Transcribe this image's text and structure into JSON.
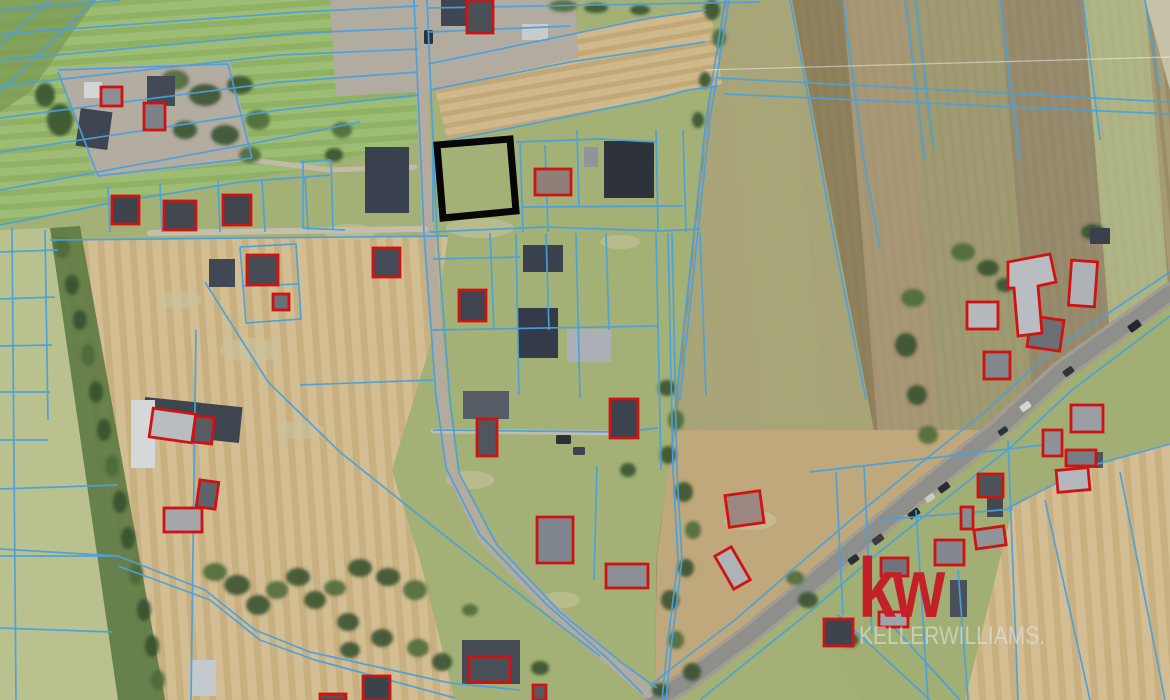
{
  "watermark": {
    "logo": "kw",
    "brand": "KELLERWILLIAMS."
  },
  "colors": {
    "parcel_line": "#4aa0dc",
    "building_outline": "#cf1313",
    "highlight": "#060606",
    "tree_dark": "#35502c",
    "tree_mid": "#4c6a39",
    "patch": "#cbc49e",
    "power_line": "rgba(255,255,255,0.45)",
    "kw_red": "#c32127",
    "brand_text": "rgba(228,233,241,0.55)",
    "base_grass": "#a3b176"
  },
  "highlight_parcel": {
    "points": "437,145 510,139 516,211 443,218",
    "stroke_width": 7
  },
  "map": {
    "patterns": [
      {
        "id": "rowsGreen",
        "c1": "#8fb163",
        "c2": "#9dbd74",
        "s": 14,
        "split": 8,
        "a": -4
      },
      {
        "id": "rowsTan",
        "c1": "#c2a877",
        "c2": "#cfb88b",
        "s": 12,
        "split": 7,
        "a": -10
      },
      {
        "id": "rowsTanV",
        "c1": "#c8b081",
        "c2": "#d3bd92",
        "s": 16,
        "split": 9,
        "a": 86
      },
      {
        "id": "rowsBrown",
        "c1": "#9a8d66",
        "c2": "#a79b73",
        "s": 10,
        "split": 6,
        "a": 84
      }
    ],
    "fields": [
      {
        "pts": "0,0 1170,0 1170,700 0,700",
        "fill": "#a3b176"
      },
      {
        "pts": "0,0 430,0 424,140 300,170 100,205 0,228",
        "fill": "p:rowsGreen"
      },
      {
        "pts": "0,0 96,0 30,92 0,112",
        "fill": "#7d9b55",
        "op": 0.8
      },
      {
        "pts": "676,400 692,250 706,120 725,0 1170,0 1170,293 1060,372 997,430 925,488 860,542 800,593 745,638 685,682 655,700 656,560 668,470",
        "fill": "p:rowsBrown"
      },
      {
        "pts": "727,0 790,0 828,470 765,470",
        "fill": "#a3a06e",
        "op": 0.8
      },
      {
        "pts": "790,0 843,0 881,470 828,470",
        "fill": "#8a7a58",
        "op": 0.8
      },
      {
        "pts": "843,0 905,0 943,470 881,470",
        "fill": "#a89674",
        "op": 0.8
      },
      {
        "pts": "905,0 1000,0 1038,470 943,470",
        "fill": "#9d9a70",
        "op": 0.8
      },
      {
        "pts": "1000,0 1083,0 1121,470 1038,470",
        "fill": "#93876b",
        "op": 0.8
      },
      {
        "pts": "1083,0 1145,0 1183,470 1121,470",
        "fill": "#b2ba8a",
        "op": 0.8
      },
      {
        "pts": "1145,0 1170,0 1170,90",
        "fill": "#c9c6ad",
        "op": 0.9
      },
      {
        "pts": "676,430 694,250 711,100 727,0 792,0 810,96 840,255 874,430",
        "fill": "#a9a578",
        "op": 0.95
      },
      {
        "pts": "925,488 1060,372 1170,293 1170,443 1090,465 1013,507 1005,700 860,700 800,593 860,542",
        "fill": "#a2af74"
      },
      {
        "pts": "676,430 874,430 997,430 925,488 860,542 800,593 745,638 685,682 655,700 657,560 668,470",
        "fill": "#bfa87b"
      },
      {
        "pts": "1013,507 1090,465 1170,443 1170,700 965,700",
        "fill": "p:rowsTanV"
      },
      {
        "pts": "50,240 448,237 432,340 392,470 420,560 455,700 160,700 96,470",
        "fill": "p:rowsTanV"
      },
      {
        "pts": "0,230 50,228 96,470 160,700 0,700",
        "fill": "#b9c28f"
      },
      {
        "pts": "50,228 80,226 165,700 118,700",
        "fill": "#5d7a44",
        "op": 0.9
      },
      {
        "pts": "428,62 650,16 710,8 722,84 690,90 448,142",
        "fill": "p:rowsTan"
      },
      {
        "pts": "58,68 230,62 254,160 96,178",
        "fill": "#b3aca0"
      },
      {
        "pts": "330,0 575,0 578,58 420,92 336,96",
        "fill": "#b2aba0"
      }
    ],
    "patches": [
      [
        480,
        228,
        34,
        10
      ],
      [
        350,
        232,
        26,
        8
      ],
      [
        620,
        242,
        20,
        7
      ],
      [
        470,
        480,
        24,
        9
      ],
      [
        560,
        600,
        20,
        8
      ],
      [
        750,
        520,
        26,
        10
      ],
      [
        250,
        350,
        30,
        12
      ],
      [
        300,
        430,
        24,
        9
      ],
      [
        180,
        300,
        22,
        9
      ]
    ],
    "roads": [
      {
        "pts": "1170,293 1060,372 997,430 925,488 860,542 800,593 745,638 685,682 655,700",
        "w": 22,
        "c": "#a29d90"
      },
      {
        "pts": "1170,293 1060,372 997,430 925,488 860,542 800,593 745,638 685,682 655,700",
        "w": 15,
        "c": "#8e8f8b"
      },
      {
        "pts": "418,0 428,233 442,400 451,470 484,538 548,606 610,660 648,692",
        "w": 12,
        "c": "#b4ab9d"
      },
      {
        "pts": "150,233 425,229",
        "w": 6,
        "c": "#c6bead"
      },
      {
        "pts": "433,431 618,433",
        "w": 5,
        "c": "#c4bcae"
      },
      {
        "pts": "252,160 330,170 415,167",
        "w": 5,
        "c": "#c2b9a8"
      }
    ],
    "vehicles": [
      [
        1128,
        322,
        13,
        8,
        -36,
        "#23272e"
      ],
      [
        1063,
        368,
        11,
        7,
        -36,
        "#30353c"
      ],
      [
        1020,
        403,
        11,
        7,
        -36,
        "#d4d6d2"
      ],
      [
        998,
        428,
        10,
        6,
        -36,
        "#2e333a"
      ],
      [
        938,
        484,
        12,
        7,
        -36,
        "#282d34"
      ],
      [
        925,
        495,
        10,
        6,
        -36,
        "#caccc8"
      ],
      [
        908,
        510,
        12,
        7,
        -36,
        "#23272e"
      ],
      [
        872,
        536,
        12,
        7,
        -36,
        "#383d44"
      ],
      [
        848,
        556,
        11,
        7,
        -36,
        "#2a2f36"
      ],
      [
        556,
        435,
        15,
        9,
        0,
        "#2c3138"
      ],
      [
        573,
        447,
        12,
        8,
        0,
        "#3d434c"
      ],
      [
        424,
        30,
        9,
        14,
        0,
        "#2e333a"
      ]
    ],
    "trees": [
      [
        175,
        80,
        14,
        10
      ],
      [
        205,
        95,
        16,
        11
      ],
      [
        240,
        85,
        13,
        9
      ],
      [
        258,
        120,
        12,
        10
      ],
      [
        225,
        135,
        14,
        10
      ],
      [
        185,
        130,
        12,
        9
      ],
      [
        250,
        155,
        11,
        8
      ],
      [
        60,
        120,
        13,
        16
      ],
      [
        45,
        95,
        10,
        12
      ],
      [
        563,
        6,
        14,
        6
      ],
      [
        596,
        8,
        12,
        5
      ],
      [
        640,
        10,
        10,
        5
      ],
      [
        342,
        130,
        10,
        8
      ],
      [
        334,
        155,
        9,
        7
      ],
      [
        712,
        10,
        8,
        10
      ],
      [
        719,
        38,
        7,
        9
      ],
      [
        705,
        80,
        6,
        8
      ],
      [
        698,
        120,
        6,
        8
      ],
      [
        963,
        252,
        12,
        9
      ],
      [
        988,
        268,
        11,
        8
      ],
      [
        1005,
        285,
        9,
        7
      ],
      [
        913,
        298,
        12,
        9
      ],
      [
        906,
        345,
        11,
        12
      ],
      [
        917,
        395,
        10,
        10
      ],
      [
        928,
        435,
        10,
        9
      ],
      [
        1093,
        232,
        12,
        8
      ],
      [
        667,
        388,
        9,
        8
      ],
      [
        676,
        420,
        8,
        10
      ],
      [
        668,
        455,
        8,
        9
      ],
      [
        684,
        492,
        9,
        10
      ],
      [
        693,
        530,
        8,
        9
      ],
      [
        686,
        568,
        8,
        9
      ],
      [
        670,
        600,
        9,
        10
      ],
      [
        676,
        640,
        8,
        9
      ],
      [
        692,
        672,
        9,
        9
      ],
      [
        660,
        690,
        8,
        7
      ],
      [
        215,
        572,
        12,
        9
      ],
      [
        237,
        585,
        13,
        10
      ],
      [
        258,
        605,
        12,
        10
      ],
      [
        277,
        590,
        11,
        9
      ],
      [
        298,
        577,
        12,
        9
      ],
      [
        315,
        600,
        11,
        9
      ],
      [
        335,
        588,
        11,
        8
      ],
      [
        360,
        568,
        12,
        9
      ],
      [
        388,
        577,
        12,
        9
      ],
      [
        415,
        590,
        12,
        10
      ],
      [
        348,
        622,
        11,
        9
      ],
      [
        382,
        638,
        11,
        9
      ],
      [
        418,
        648,
        11,
        9
      ],
      [
        442,
        662,
        10,
        9
      ],
      [
        350,
        650,
        10,
        8
      ],
      [
        62,
        248,
        8,
        10
      ],
      [
        72,
        285,
        7,
        10
      ],
      [
        80,
        320,
        7,
        10
      ],
      [
        88,
        355,
        7,
        11
      ],
      [
        96,
        392,
        7,
        11
      ],
      [
        104,
        430,
        7,
        11
      ],
      [
        112,
        466,
        7,
        11
      ],
      [
        120,
        502,
        7,
        11
      ],
      [
        128,
        538,
        7,
        11
      ],
      [
        136,
        574,
        7,
        11
      ],
      [
        144,
        610,
        7,
        11
      ],
      [
        152,
        646,
        7,
        11
      ],
      [
        158,
        680,
        7,
        10
      ],
      [
        500,
        655,
        10,
        8
      ],
      [
        540,
        668,
        9,
        7
      ],
      [
        470,
        610,
        8,
        6
      ],
      [
        628,
        470,
        8,
        7
      ],
      [
        808,
        600,
        10,
        8
      ],
      [
        795,
        578,
        9,
        7
      ],
      [
        850,
        640,
        9,
        7
      ]
    ],
    "buildings": [
      [
        78,
        110,
        32,
        38,
        8,
        "#3e4450"
      ],
      [
        84,
        82,
        18,
        16,
        0,
        "#d3d6d6"
      ],
      [
        147,
        76,
        28,
        30,
        0,
        "#434955"
      ],
      [
        209,
        259,
        26,
        28,
        0,
        "#414754"
      ],
      [
        365,
        147,
        44,
        66,
        0,
        "#39404e"
      ],
      [
        441,
        0,
        36,
        26,
        0,
        "#3f4552"
      ],
      [
        522,
        24,
        26,
        16,
        0,
        "#c8ccce"
      ],
      [
        584,
        147,
        14,
        20,
        0,
        "#8f959b"
      ],
      [
        604,
        141,
        50,
        57,
        0,
        "#2e333b"
      ],
      [
        523,
        245,
        40,
        27,
        0,
        "#39404e"
      ],
      [
        518,
        308,
        40,
        50,
        0,
        "#333a48"
      ],
      [
        567,
        329,
        44,
        33,
        0,
        "#aab0b6"
      ],
      [
        462,
        640,
        58,
        44,
        0,
        "#454b55"
      ],
      [
        463,
        391,
        46,
        28,
        0,
        "#565c66"
      ],
      [
        143,
        402,
        98,
        36,
        6,
        "#3f454e"
      ],
      [
        131,
        400,
        24,
        68,
        0,
        "#d5d8d8"
      ],
      [
        190,
        660,
        26,
        36,
        0,
        "#c3c9cc"
      ],
      [
        950,
        580,
        17,
        37,
        0,
        "#4b5158"
      ],
      [
        987,
        497,
        16,
        20,
        0,
        "#43494f"
      ],
      [
        1090,
        228,
        20,
        16,
        0,
        "#3a404c"
      ],
      [
        1085,
        452,
        18,
        16,
        0,
        "#4f555c"
      ]
    ],
    "parcel_lines": [
      "0,10 120,0",
      "0,34 300,12 418,6",
      "0,60 300,33 418,28",
      "0,86 280,55 418,49",
      "0,118 280,82 418,72",
      "0,152 280,110 418,95",
      "0,190 260,142 360,122",
      "0,225 100,205 240,182 330,175",
      "0,45 50,0",
      "0,92 95,0",
      "428,8 760,2",
      "428,32 570,26",
      "430,90 570,62 705,42",
      "428,64 650,18 706,10",
      "446,141 650,100 688,90 718,86",
      "718,78 1170,102",
      "724,94 1170,114",
      "414,0 424,233 436,395 446,468 480,535 545,603 607,658 643,694",
      "427,0 437,233 450,400 459,473 497,545 560,612 622,663 657,688",
      "205,282 268,382 340,452 440,532 540,610 600,656",
      "520,143 523,232",
      "545,145 548,232",
      "577,130 579,208",
      "656,130 658,232",
      "683,130 686,232",
      "516,142 600,139 656,142",
      "523,207 683,206",
      "430,232 545,227 660,231 700,229",
      "433,259 520,257",
      "433,143 433,222",
      "303,160 303,228",
      "331,160 333,230",
      "300,162 331,160",
      "302,228 345,230",
      "490,233 494,330",
      "516,233 519,395",
      "546,233 549,330",
      "576,233 580,398",
      "606,233 609,330",
      "656,233 661,470",
      "668,233 673,470 678,560 668,640 662,700",
      "672,233 677,470 682,560 672,640 666,700",
      "700,233 706,395",
      "432,330 658,326",
      "300,385 433,380",
      "433,430 620,432 658,428",
      "597,466 594,580",
      "58,70 228,64",
      "228,64 252,158",
      "252,158 98,176",
      "98,176 58,72",
      "108,186 110,232",
      "160,184 162,232",
      "218,181 220,232",
      "262,179 265,232",
      "305,177 308,230",
      "50,240 448,236",
      "240,247 296,244 301,319 246,323 240,247",
      "242,286 299,284",
      "12,228 16,700",
      "45,230 48,420",
      "0,252 58,250",
      "0,299 55,297",
      "0,346 52,345",
      "0,392 50,392",
      "0,440 48,440",
      "0,489 118,485",
      "0,556 118,556",
      "0,628 112,632",
      "0,549 118,556 205,590 255,630 310,652 450,683 520,690",
      "118,566 210,600 260,640 315,660 455,698",
      "196,330 191,700",
      "725,0 706,120 692,250 676,400",
      "729,0 710,120 696,250 680,400",
      "790,0 808,96 836,250 866,400",
      "843,0 862,150 880,250",
      "905,0 925,160",
      "915,0 934,150",
      "1000,0 1020,160",
      "1083,0 1100,140",
      "1145,0 1160,90",
      "1170,272 1050,352 985,412 912,470 846,524 790,572 735,620 672,668 650,686",
      "1170,316 1072,390 1010,448 938,505 872,558 812,610 752,658 700,700",
      "1008,440 1018,700",
      "916,510 928,700",
      "958,570 968,700",
      "880,520 1013,509",
      "1008,508 1090,466 1170,444",
      "1045,500 1090,700",
      "1120,472 1165,700",
      "836,472 843,615",
      "864,466 872,633",
      "810,472 1060,443",
      "838,615 930,700",
      "880,612 960,700"
    ],
    "power_lines": [
      "705,70 1170,57"
    ],
    "red_buildings": [
      [
        101,
        87,
        21,
        19,
        0,
        "#8a8f94"
      ],
      [
        144,
        103,
        21,
        27,
        0,
        "#7d8287"
      ],
      [
        112,
        196,
        27,
        28,
        0,
        "#3f444c"
      ],
      [
        164,
        201,
        32,
        29,
        0,
        "#43484f"
      ],
      [
        223,
        195,
        28,
        30,
        0,
        "#40454d"
      ],
      [
        247,
        255,
        31,
        30,
        0,
        "#474c54"
      ],
      [
        273,
        294,
        16,
        16,
        0,
        "#6b7076"
      ],
      [
        467,
        0,
        26,
        33,
        0,
        "#4a5058"
      ],
      [
        151,
        411,
        43,
        29,
        8,
        "#b9bdc2"
      ],
      [
        194,
        417,
        19,
        26,
        6,
        "#585d64"
      ],
      [
        164,
        508,
        38,
        24,
        0,
        "#a4a6aa"
      ],
      [
        198,
        481,
        19,
        27,
        8,
        "#5e6369"
      ],
      [
        373,
        248,
        27,
        29,
        0,
        "#454b58"
      ],
      [
        459,
        290,
        27,
        31,
        0,
        "#3f4550"
      ],
      [
        535,
        169,
        36,
        26,
        0,
        "#8f7f78"
      ],
      [
        610,
        399,
        28,
        39,
        0,
        "#3d434e"
      ],
      [
        477,
        419,
        20,
        37,
        0,
        "#50565e"
      ],
      [
        537,
        517,
        36,
        46,
        0,
        "#7f858c"
      ],
      [
        606,
        564,
        42,
        24,
        0,
        "#8b9096"
      ],
      [
        727,
        493,
        35,
        32,
        -8,
        "#9c8680"
      ],
      [
        723,
        549,
        19,
        38,
        -30,
        "#aeb3b7"
      ],
      [
        469,
        657,
        41,
        25,
        0,
        "#4a5057"
      ],
      [
        533,
        685,
        13,
        15,
        0,
        "#555a61"
      ],
      [
        824,
        619,
        29,
        27,
        0,
        "#3e444c"
      ],
      [
        879,
        612,
        29,
        15,
        0,
        "#9fa4a9"
      ],
      [
        881,
        558,
        27,
        18,
        0,
        "#6e747a"
      ],
      [
        935,
        540,
        29,
        25,
        0,
        "#83888e"
      ],
      [
        975,
        528,
        30,
        19,
        -8,
        "#90959a"
      ],
      [
        961,
        507,
        12,
        22,
        0,
        "#878c92"
      ],
      [
        978,
        474,
        25,
        23,
        0,
        "#4d535b"
      ],
      [
        1057,
        469,
        32,
        22,
        -5,
        "#b4b8bc"
      ],
      [
        1070,
        261,
        26,
        45,
        4,
        "#aeb2b7"
      ],
      [
        967,
        302,
        31,
        27,
        0,
        "#b5b9bd"
      ],
      [
        1029,
        318,
        33,
        31,
        8,
        "#6a7076"
      ],
      [
        984,
        352,
        26,
        27,
        0,
        "#82878d"
      ],
      [
        1071,
        405,
        32,
        27,
        0,
        "#9b9fa4"
      ],
      [
        1043,
        430,
        19,
        26,
        0,
        "#8e9398"
      ],
      [
        1066,
        450,
        30,
        16,
        0,
        "#777d83"
      ],
      [
        363,
        676,
        27,
        24,
        0,
        "#3c424a"
      ],
      [
        320,
        694,
        26,
        6,
        0,
        "#4e545b"
      ]
    ],
    "red_paths": [
      {
        "d": "M1008,262 L1050,254 L1056,282 L1038,286 L1042,333 L1018,336 L1014,288 L1008,288 Z",
        "f": "#b9bdc1"
      }
    ]
  }
}
